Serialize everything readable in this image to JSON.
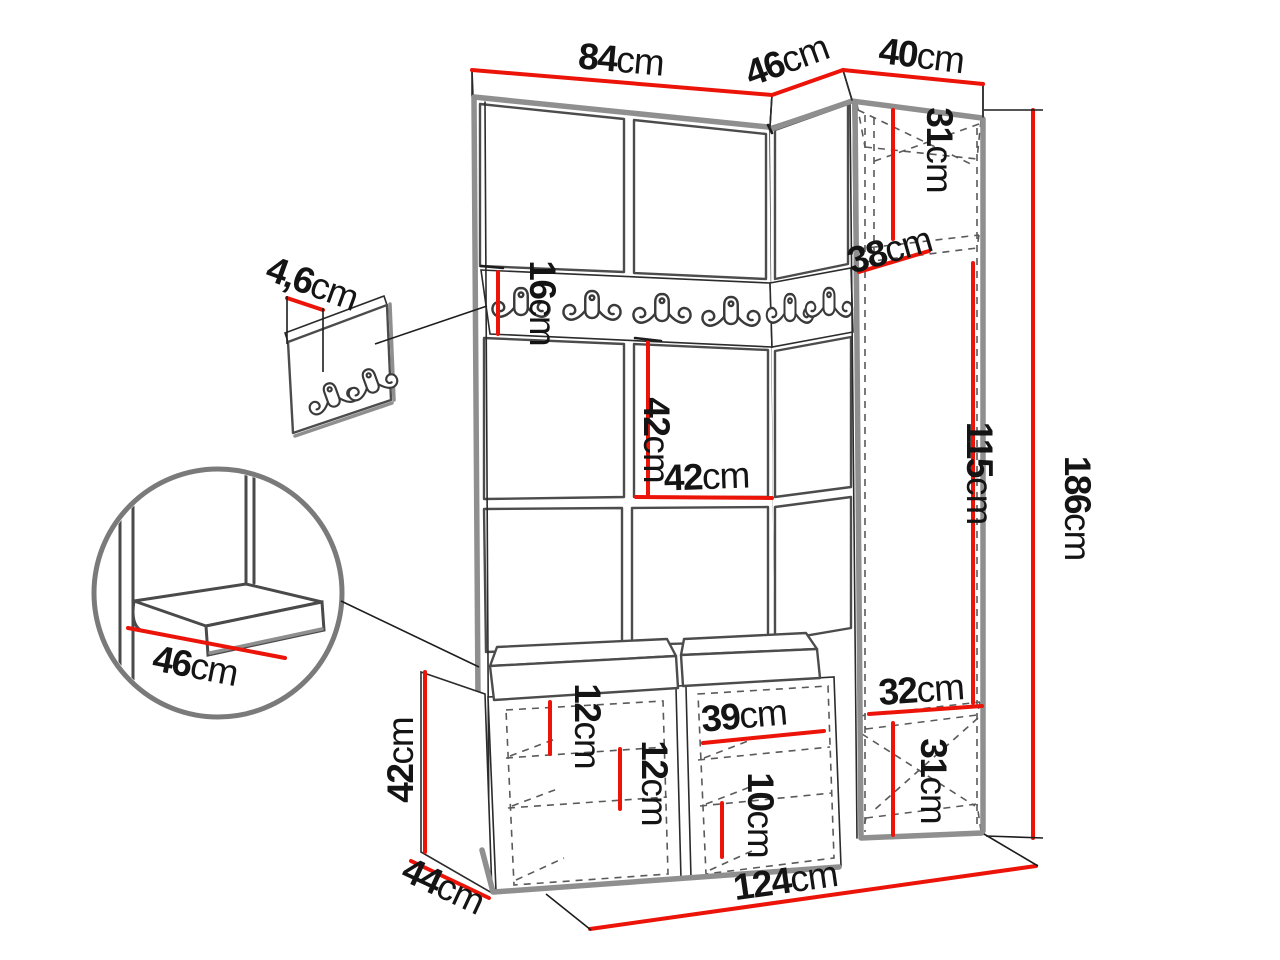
{
  "colors": {
    "dimension": "#ec1408",
    "outline": "#2b2b2b",
    "edge": "#8f8f8f",
    "dash": "#5a5a5a",
    "text": "#141414"
  },
  "diagram": {
    "type": "furniture-dimension-diagram",
    "unit_system": "cm"
  },
  "dimensions": {
    "top_width": {
      "value": "84",
      "unit": "cm"
    },
    "corner_width": {
      "value": "46",
      "unit": "cm"
    },
    "cabinet_width": {
      "value": "40",
      "unit": "cm"
    },
    "cabinet_top_height": {
      "value": "31",
      "unit": "cm"
    },
    "cabinet_shelf_depth": {
      "value": "38",
      "unit": "cm"
    },
    "cabinet_middle_height": {
      "value": "115",
      "unit": "cm"
    },
    "total_height": {
      "value": "186",
      "unit": "cm"
    },
    "rail_height": {
      "value": "16",
      "unit": "cm"
    },
    "panel_height": {
      "value": "42",
      "unit": "cm"
    },
    "panel_width": {
      "value": "42",
      "unit": "cm"
    },
    "hook_panel_thickness": {
      "value": "4,6",
      "unit": "cm"
    },
    "seat_depth": {
      "value": "46",
      "unit": "cm"
    },
    "bench_height": {
      "value": "42",
      "unit": "cm"
    },
    "bench_depth": {
      "value": "44",
      "unit": "cm"
    },
    "total_width": {
      "value": "124",
      "unit": "cm"
    },
    "shoe_top_gap": {
      "value": "12",
      "unit": "cm"
    },
    "shoe_mid_gap": {
      "value": "12",
      "unit": "cm"
    },
    "shoe_shelf_width": {
      "value": "39",
      "unit": "cm"
    },
    "shoe_bottom_gap": {
      "value": "10",
      "unit": "cm"
    },
    "cabinet_bottom_depth": {
      "value": "32",
      "unit": "cm"
    },
    "cabinet_bottom_height": {
      "value": "31",
      "unit": "cm"
    }
  }
}
